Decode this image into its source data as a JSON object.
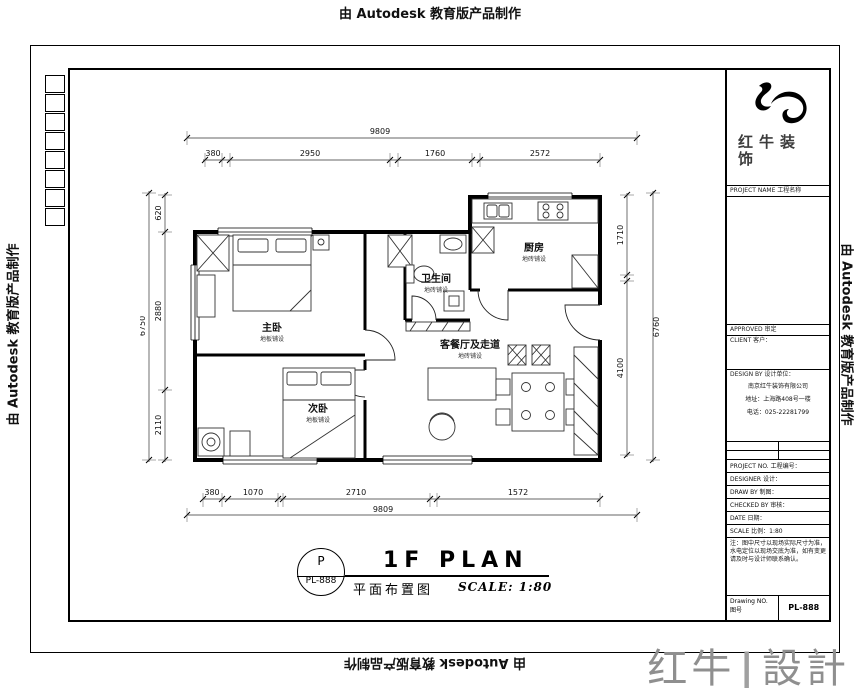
{
  "watermark": {
    "text": "由 Autodesk 教育版产品制作"
  },
  "brand": {
    "left": "红牛",
    "divider": "|",
    "right": "設計"
  },
  "title_block": {
    "logo_line1": "红牛装",
    "logo_line2": "饰",
    "row_project_name": "PROJECT NAME 工程名称",
    "row_approved": "APPROVED 审定",
    "row_client": "CLIENT 客户：",
    "design_by_header": "DESIGN BY 设计单位：",
    "company_name": "南京红牛装饰有限公司",
    "company_addr": "地址：上海路408号一楼",
    "company_tel": "电话：025-22281799",
    "fields": [
      {
        "label": "PROJECT NO. 工程编号："
      },
      {
        "label": "DESIGNER 设计："
      },
      {
        "label": "DRAW BY 制图："
      },
      {
        "label": "CHECKED BY 审核："
      },
      {
        "label": "DATE 日期："
      },
      {
        "label": "SCALE 比例：1:80"
      }
    ],
    "notes": "注：图中尺寸以现场实际尺寸为准，水电定位以现场交底为准，如有变更请及时与设计师联系确认。",
    "drawing_no_label": "Drawing NO. 图号",
    "drawing_no_value": "PL-888"
  },
  "plan": {
    "rooms": [
      {
        "name": "主卧",
        "finish": "地板铺设"
      },
      {
        "name": "次卧",
        "finish": "地板铺设"
      },
      {
        "name": "卫生间",
        "finish": "地砖铺设"
      },
      {
        "name": "厨房",
        "finish": "地砖铺设"
      },
      {
        "name": "客餐厅及走道",
        "finish": "地砖铺设"
      }
    ],
    "dims": {
      "top_total": "9809",
      "top_chain": [
        "380",
        "2950",
        "1760",
        "2572"
      ],
      "bottom_chain": [
        "380",
        "1070",
        "2710",
        "1572"
      ],
      "bottom_total": "9809",
      "left_chain": [
        "620",
        "2880",
        "2110"
      ],
      "left_total": "6750",
      "right_chain": [
        "1710",
        "4100"
      ],
      "right_total": "6760"
    }
  },
  "footer": {
    "stamp_top": "P",
    "stamp_bottom": "PL-888",
    "title_en": "1F PLAN",
    "title_cn": "平面布置图",
    "scale_text": "SCALE: 1:80"
  }
}
